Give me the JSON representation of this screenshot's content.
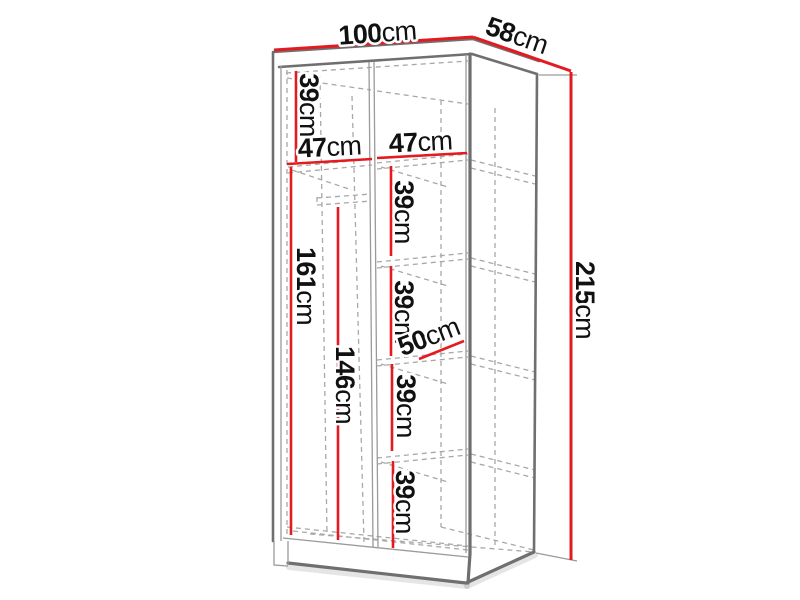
{
  "diagram": {
    "type": "furniture-dimension-drawing",
    "subject": "wardrobe interior with hanging section and shelf column",
    "unit": "cm",
    "colors": {
      "dim": "#e31b20",
      "outline": "#6f6f6f",
      "outline-light": "#9a9a9a",
      "hidden": "#a8a8a8",
      "text": "#111111",
      "bg": "#ffffff"
    },
    "dimensions": {
      "overall_width": {
        "value": "100",
        "unit": "cm"
      },
      "overall_depth": {
        "value": "58",
        "unit": "cm"
      },
      "overall_height": {
        "value": "215",
        "unit": "cm"
      },
      "top_section_height": {
        "value": "39",
        "unit": "cm"
      },
      "left_section_width": {
        "value": "47",
        "unit": "cm"
      },
      "right_section_width": {
        "value": "47",
        "unit": "cm"
      },
      "left_section_height": {
        "value": "161",
        "unit": "cm"
      },
      "hanging_rail_height": {
        "value": "146",
        "unit": "cm"
      },
      "shelf_gap_1": {
        "value": "39",
        "unit": "cm"
      },
      "shelf_gap_2": {
        "value": "39",
        "unit": "cm"
      },
      "shelf_gap_3": {
        "value": "39",
        "unit": "cm"
      },
      "shelf_gap_4": {
        "value": "39",
        "unit": "cm"
      },
      "shelf_depth": {
        "value": "50",
        "unit": "cm"
      }
    }
  }
}
